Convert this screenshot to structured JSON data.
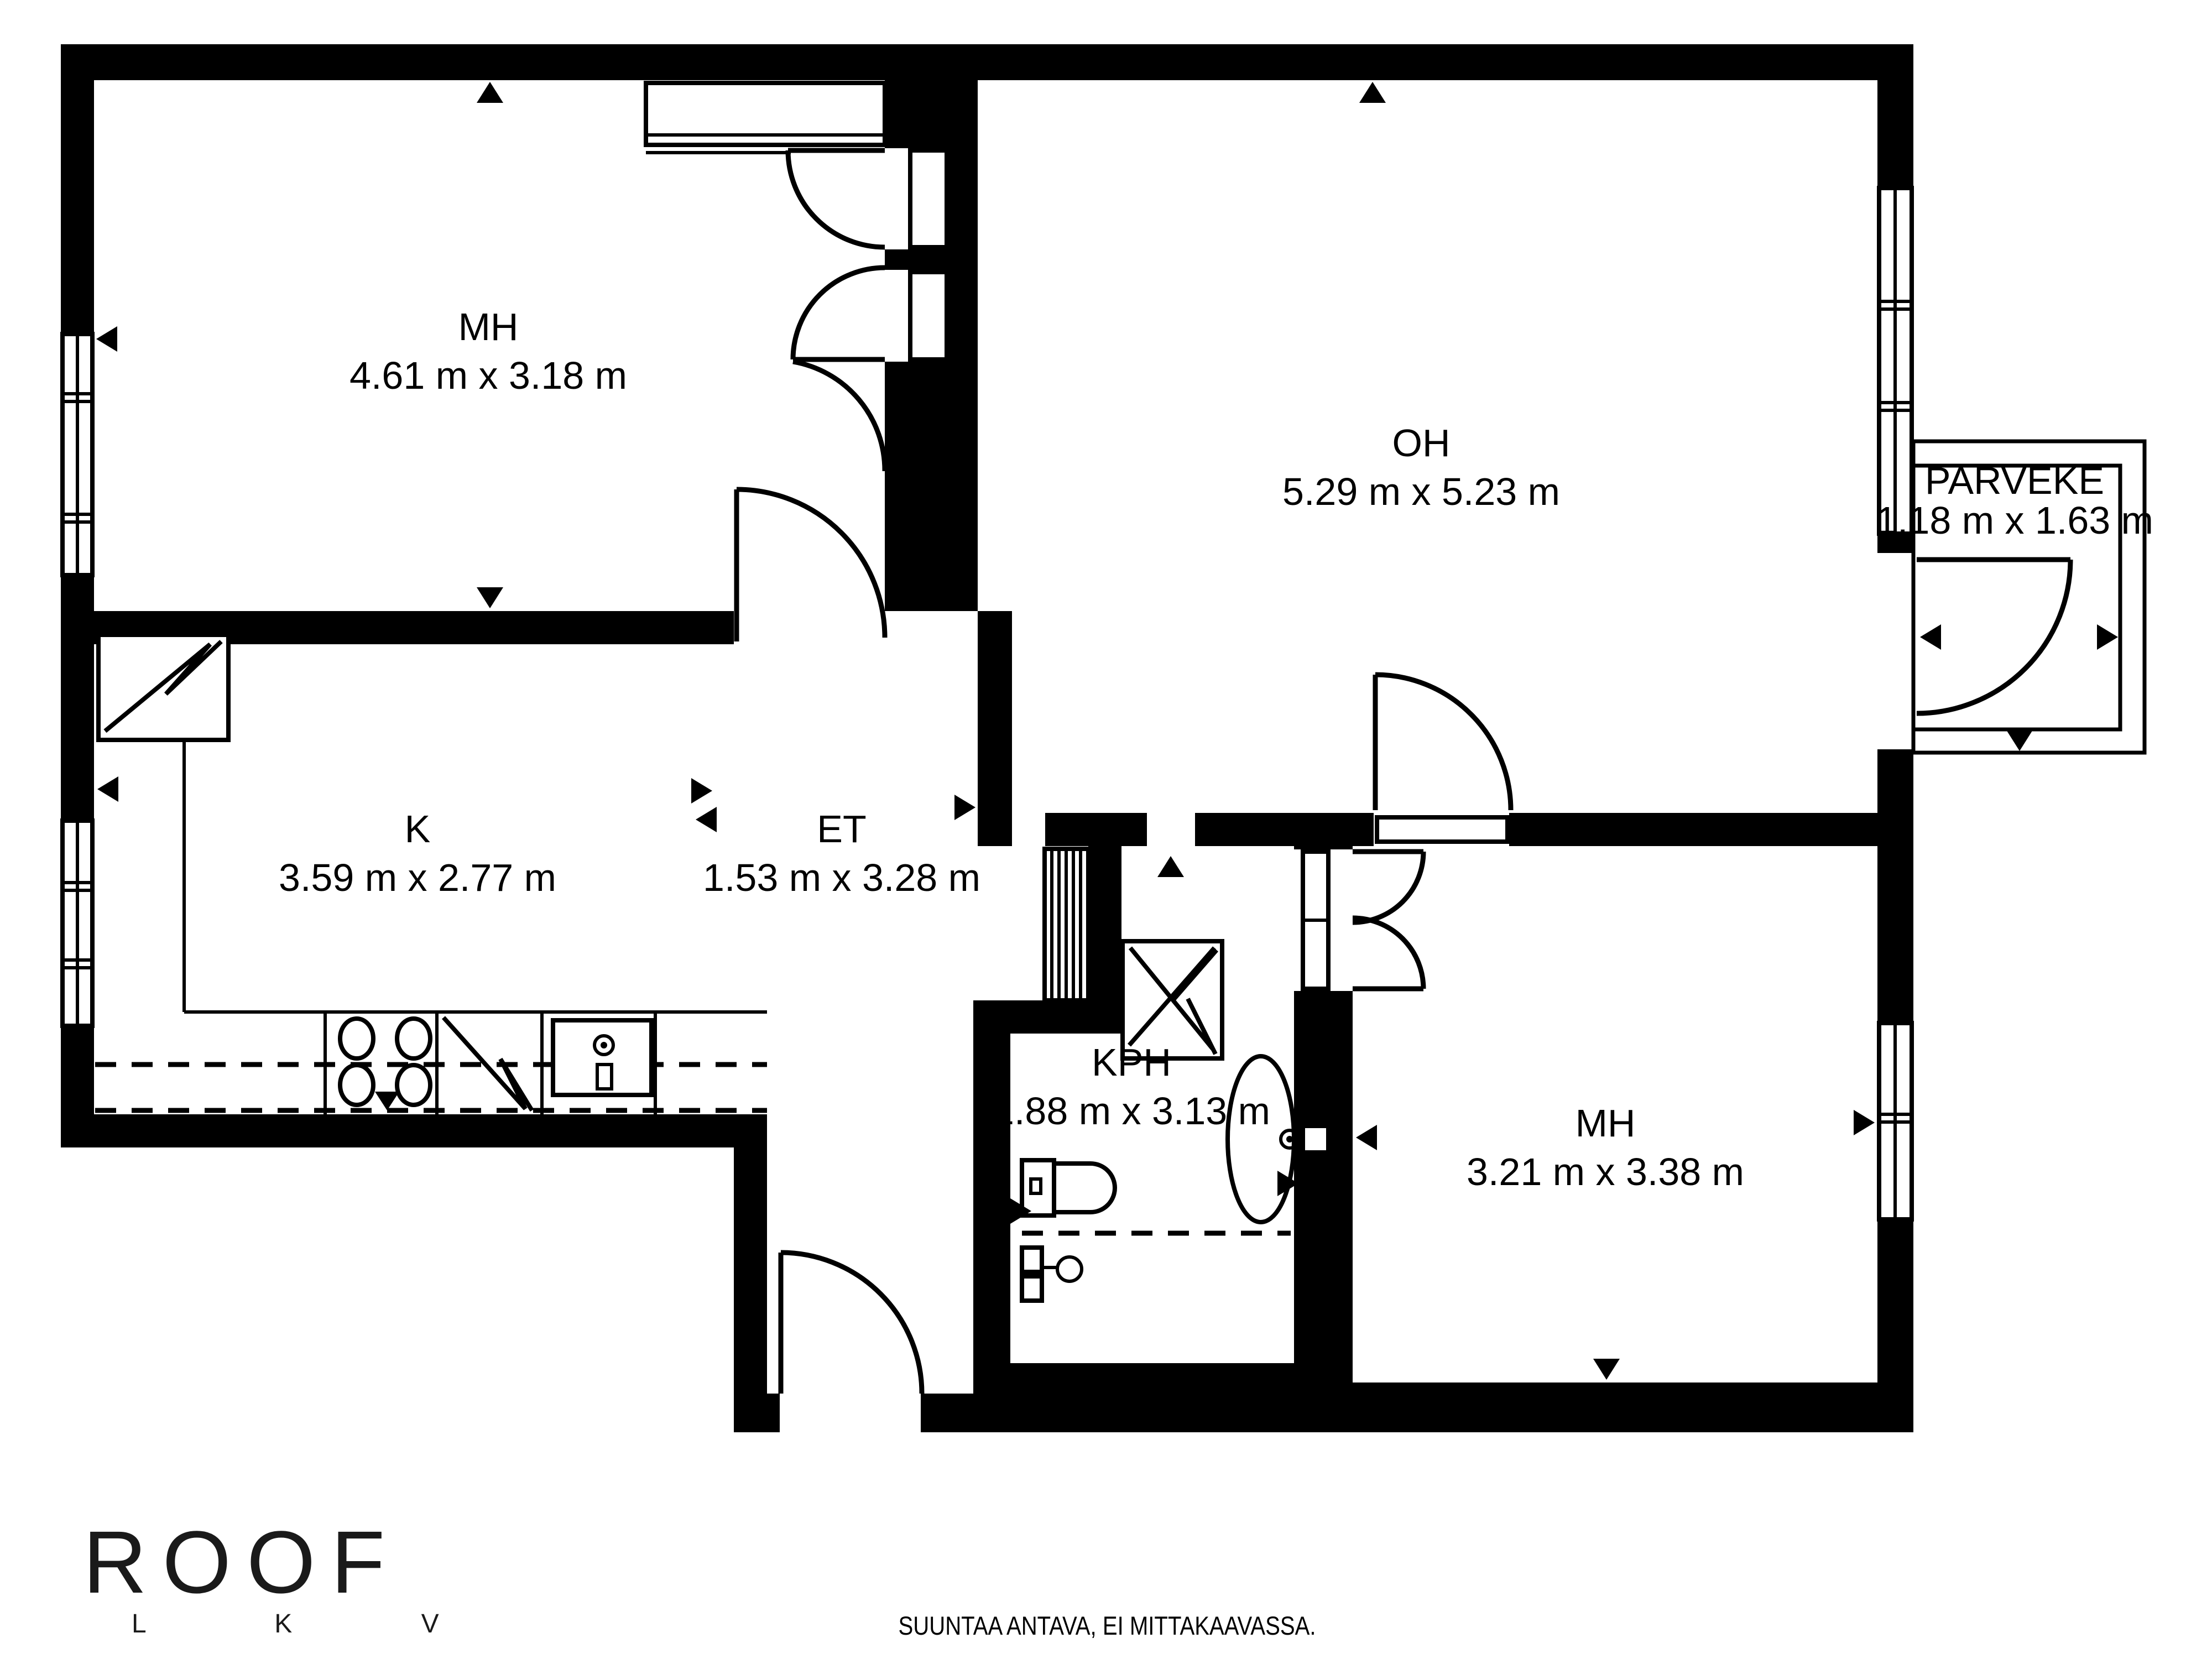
{
  "plan": {
    "rooms": [
      {
        "id": "bedroom-1",
        "label": "MH",
        "dims": "4.61 m x 3.18 m"
      },
      {
        "id": "living-room",
        "label": "OH",
        "dims": "5.29 m x 5.23 m"
      },
      {
        "id": "balcony",
        "label": "PARVEKE",
        "dims": "1.18 m x 1.63 m"
      },
      {
        "id": "kitchen",
        "label": "K",
        "dims": "3.59 m x 2.77 m"
      },
      {
        "id": "hallway",
        "label": "ET",
        "dims": "1.53 m x 3.28 m"
      },
      {
        "id": "bathroom",
        "label": "KPH",
        "dims": "1.88 m x 3.13 m"
      },
      {
        "id": "bedroom-2",
        "label": "MH",
        "dims": "3.21 m x 3.38 m"
      }
    ],
    "fixtures": [
      "wardrobe",
      "refrigerator",
      "stove",
      "dishwasher",
      "kitchen-sink",
      "coat-closet",
      "washing-machine",
      "toilet",
      "shower-mixer",
      "washbasin"
    ],
    "colors": {
      "wall": "#000000",
      "background": "#ffffff"
    }
  },
  "footer": {
    "logo_text": "ROOF",
    "logo_sub": "L K V",
    "disclaimer": "SUUNTAA ANTAVA, EI MITTAKAAVASSA."
  }
}
